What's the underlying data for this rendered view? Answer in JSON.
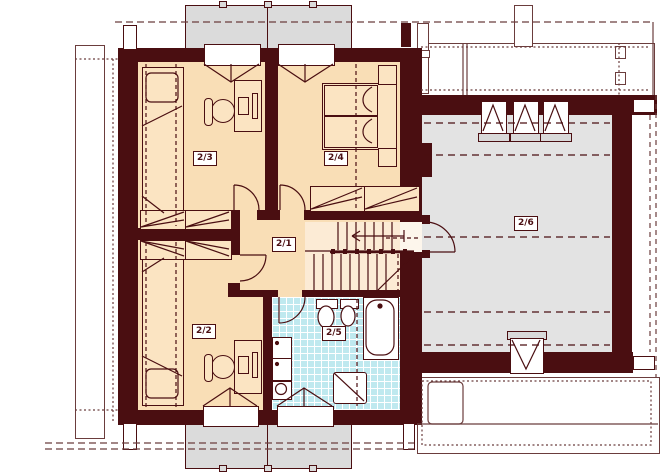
{
  "plan": {
    "kind": "floor-plan",
    "rooms": [
      {
        "id": "2/1"
      },
      {
        "id": "2/2"
      },
      {
        "id": "2/3"
      },
      {
        "id": "2/4"
      },
      {
        "id": "2/5"
      },
      {
        "id": "2/6"
      }
    ],
    "colors": {
      "wall": "#4a0e11",
      "room_fill": "#f9deb6",
      "stairs_fill": "#fcebd5",
      "bathroom_fill": "#bfe9ef",
      "attic_room_fill": "#e3e3e3",
      "dormer_fill": "#dbdbdb",
      "roof_line": "#6b3d3d"
    }
  }
}
